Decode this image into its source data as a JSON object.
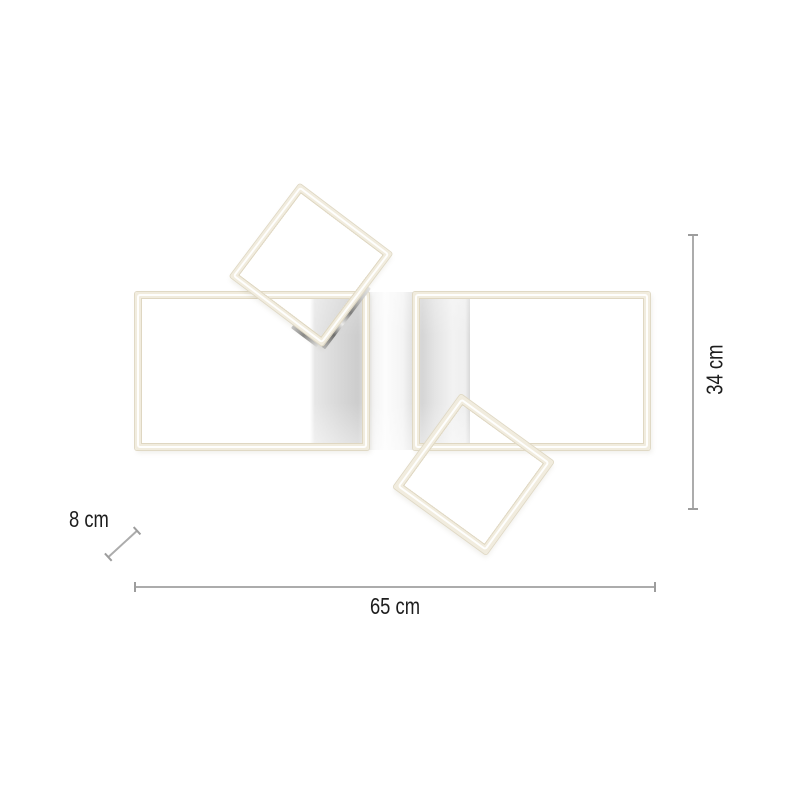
{
  "diagram": {
    "type": "product-dimension-diagram",
    "subject": "ceiling-light-with-two-rectangular-and-two-square-led-frames",
    "dimensions": {
      "width": {
        "label": "65 cm"
      },
      "height": {
        "label": "34 cm"
      },
      "depth": {
        "label": "8 cm"
      }
    },
    "colors": {
      "background": "#ffffff",
      "frame_cream": "#f1ecde",
      "frame_edge": "#e0d9c5",
      "frame_highlight": "#ffffff",
      "canopy_gray": "#cdcdcd",
      "chrome_dark": "#6e6e6e",
      "dimension_line": "#acacac",
      "label_text": "#1d1d1d"
    }
  }
}
